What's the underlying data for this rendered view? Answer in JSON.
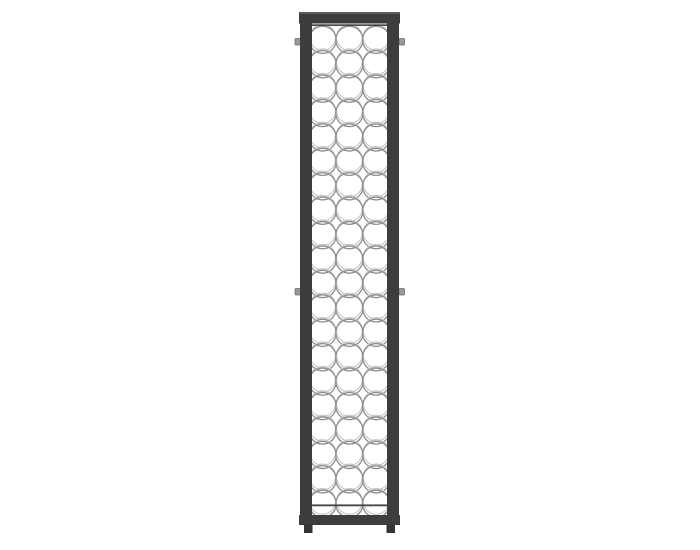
{
  "scene": {
    "description": "Product photo of a tall narrow wall-mounted metal wine rack standing on a plain white background, centered horizontally",
    "product": "wine-rack",
    "visible_text": ""
  },
  "colors": {
    "background": "#ffffff",
    "frame": "#3d3d3d",
    "frame_highlight": "#606060",
    "leg": "#353535",
    "rail": "#4a4a4a",
    "ring_front": "#8d8d8d",
    "ring_back": "#c4c4c4",
    "bracket_fill": "#999999",
    "bracket_edge": "#6a6a6a"
  },
  "grid": {
    "columns": 3,
    "rows": 20,
    "total_slots": 60,
    "first_cx": 322.6,
    "first_cy": 39.8,
    "dx": 26.8,
    "dy": 24.42,
    "radius": 13.6,
    "front_stroke_width": 1.3,
    "back_ring_offset": -2.4,
    "back_ring_radius": 12.9,
    "back_stroke_width": 1.05
  },
  "brackets": {
    "width": 5.5,
    "height": 6.5,
    "items": [
      {
        "x": 295.0,
        "y": 38.5,
        "side": "left-top"
      },
      {
        "x": 399.0,
        "y": 38.5,
        "side": "right-top"
      },
      {
        "x": 295.0,
        "y": 288.5,
        "side": "left-middle"
      },
      {
        "x": 399.0,
        "y": 288.5,
        "side": "right-middle"
      }
    ]
  }
}
